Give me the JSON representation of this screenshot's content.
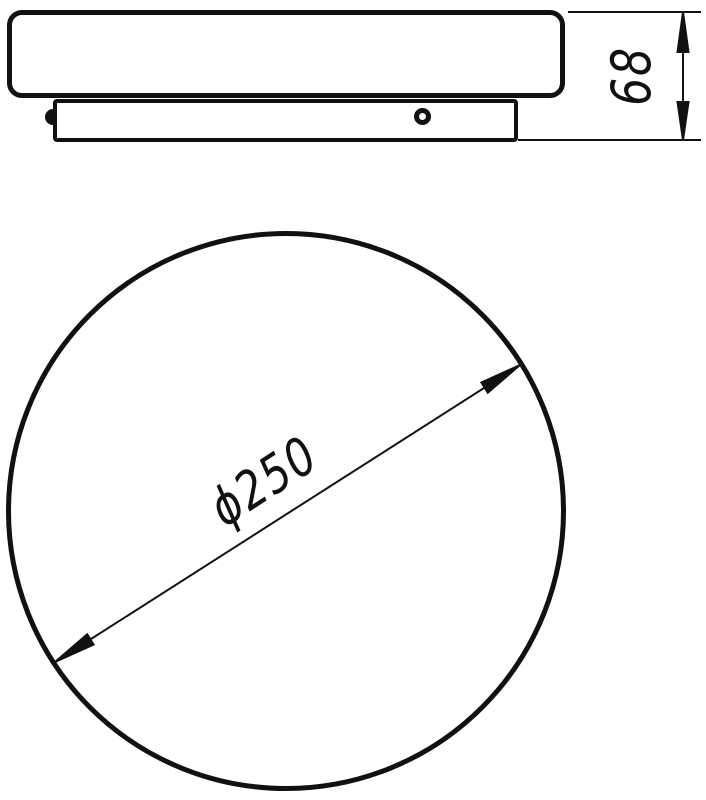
{
  "drawing": {
    "labels": {
      "height_dim": "68",
      "diameter_dim": "ϕ250"
    },
    "colors": {
      "ink": "#111111",
      "paper": "#ffffff"
    }
  }
}
